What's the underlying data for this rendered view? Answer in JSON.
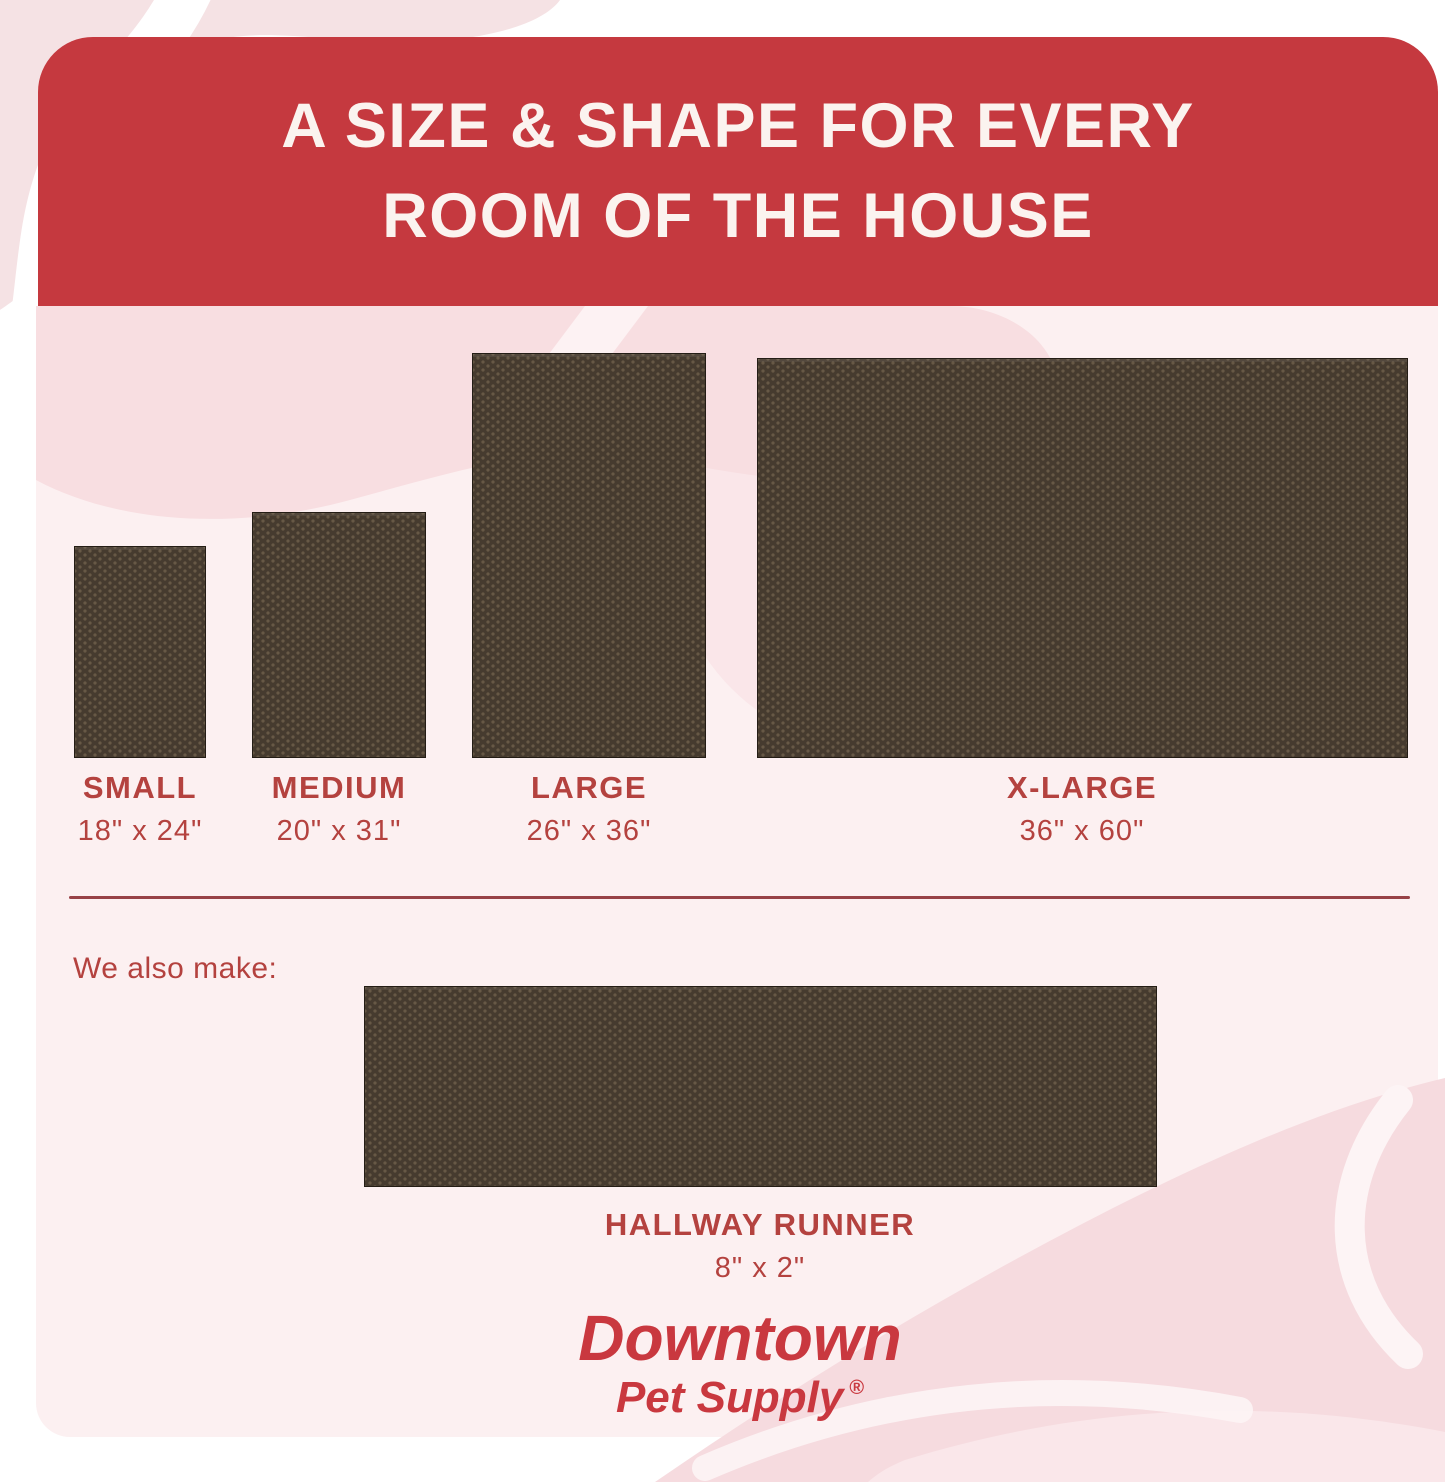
{
  "header": {
    "title_line1": "A SIZE & SHAPE FOR EVERY",
    "title_line2": "ROOM OF THE HOUSE"
  },
  "mats": [
    {
      "name": "small",
      "label": "SMALL",
      "size": "18\" x 24\""
    },
    {
      "name": "medium",
      "label": "MEDIUM",
      "size": "20\" x 31\""
    },
    {
      "name": "large",
      "label": "LARGE",
      "size": "26\" x 36\""
    },
    {
      "name": "x-large",
      "label": "X-LARGE",
      "size": "36\" x 60\""
    }
  ],
  "also_make": {
    "heading": "We also make:",
    "runner_label": "HALLWAY RUNNER",
    "runner_size": "8\" x 2\""
  },
  "logo": {
    "brand_line1": "Downtown",
    "brand_line2": "Pet Supply",
    "registered_mark": "®"
  },
  "colors": {
    "header_red": "#c5393f",
    "label_red": "#b4423f",
    "logo_red": "#c9383f",
    "mat_brown": "#463b2f",
    "card_pink": "#fcf0f1",
    "accent_pink": "#f6dfe2"
  }
}
